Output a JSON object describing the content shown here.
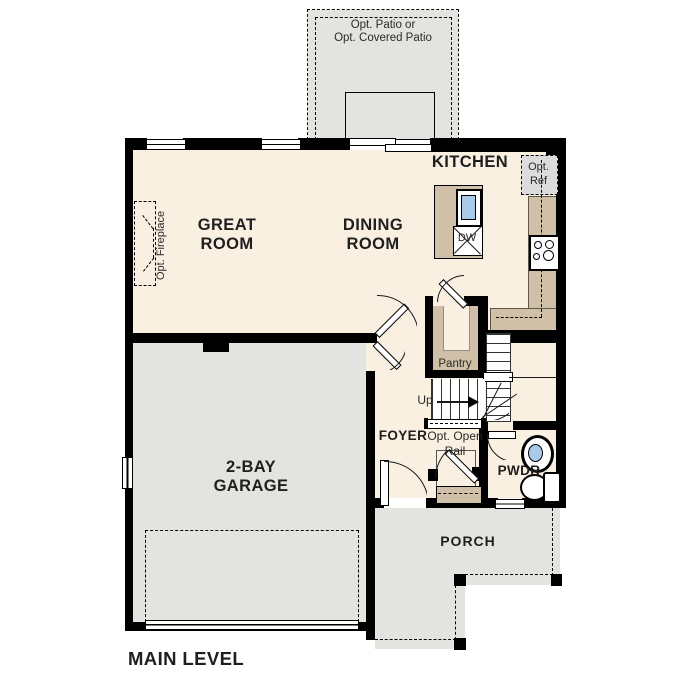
{
  "colors": {
    "wall": "#000000",
    "floor": "#f9f0e2",
    "surface": "#e3e3e0",
    "counter": "#cfc0a7",
    "water": "#a9c9e8",
    "optbox": "#dcdcdc"
  },
  "floorplan": {
    "level_label": "MAIN LEVEL",
    "rooms": {
      "great_room": "GREAT ROOM",
      "dining_room": "DINING ROOM",
      "kitchen": "KITCHEN",
      "garage": "2-BAY GARAGE",
      "foyer": "FOYER",
      "powder": "PWDR",
      "porch": "PORCH",
      "pantry": "Pantry"
    },
    "annotations": {
      "patio": [
        "Opt. Patio or",
        "Opt. Covered Patio"
      ],
      "fireplace": "Opt. Fireplace",
      "refrigerator": [
        "Opt.",
        "Ref"
      ],
      "open_rail": [
        "Opt. Open",
        "Rail"
      ],
      "up": "Up",
      "dishwasher": "DW"
    }
  }
}
